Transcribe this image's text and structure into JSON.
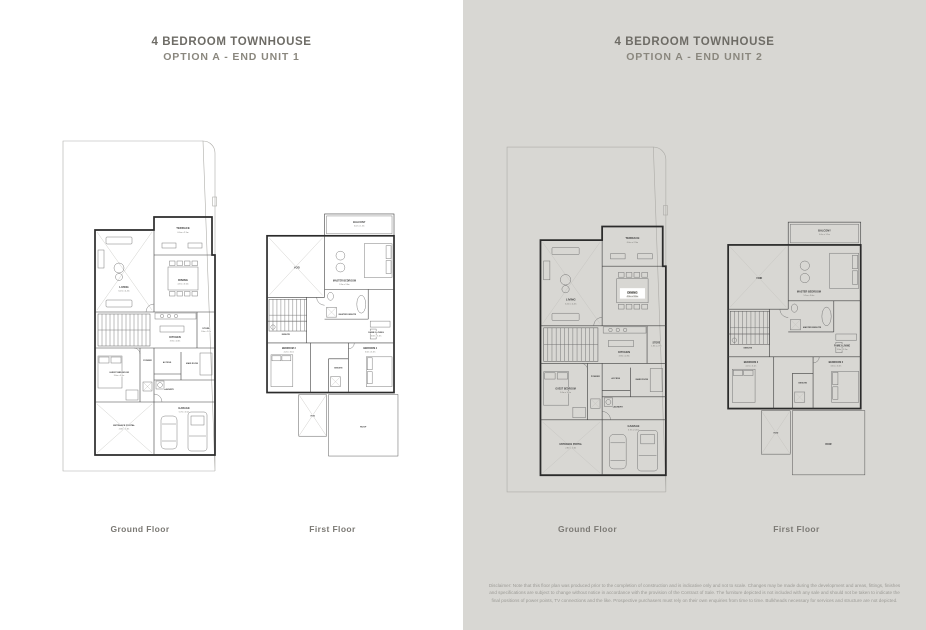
{
  "units": [
    {
      "title": "4 BEDROOM TOWNHOUSE",
      "subtitle": "OPTION A - END UNIT 1",
      "ground_floor_label": "Ground Floor",
      "first_floor_label": "First Floor"
    },
    {
      "title": "4 BEDROOM TOWNHOUSE",
      "subtitle": "OPTION A - END UNIT 2",
      "ground_floor_label": "Ground Floor",
      "first_floor_label": "First Floor"
    }
  ],
  "rooms": {
    "terrace": {
      "label": "TERRACE",
      "dims": "6.0m x 2.9m"
    },
    "living": {
      "label": "LIVING",
      "dims": "6.2m x 4.4m"
    },
    "dining": {
      "label": "DINING",
      "dims": "4.3m x 3.6m"
    },
    "kitchen": {
      "label": "KITCHEN",
      "dims": "3.9m x 2.8m"
    },
    "store": {
      "label": "STORE",
      "dims": "1.8m x 2.7m"
    },
    "guest_bedroom": {
      "label": "GUEST BEDROOM",
      "dims": "3.6m x 3.2m"
    },
    "powder": {
      "label": "POWDER"
    },
    "access": {
      "label": "ACCESS"
    },
    "maid_room": {
      "label": "MAID ROOM",
      "dims": "2.8m x 2.3m"
    },
    "laundry": {
      "label": "LAUNDRY"
    },
    "garage": {
      "label": "GARAGE",
      "dims": "5.7m x 5.5m"
    },
    "entrance_portal": {
      "label": "ENTRANCE PORTAL",
      "dims": "2.8m x 2.3m"
    },
    "balcony": {
      "label": "BALCONY",
      "dims": "6.0m x 1.5m"
    },
    "void": {
      "label": "VOID"
    },
    "master_bedroom": {
      "label": "MASTER BEDROOM",
      "dims": "5.9m x 3.6m"
    },
    "master_ensuite": {
      "label": "MASTER ENSUITE"
    },
    "family_living": {
      "label": "FAMILY LIVING",
      "dims": "3.8m x 3.3m"
    },
    "ensuite": {
      "label": "ENSUITE"
    },
    "bedroom3": {
      "label": "BEDROOM 3",
      "dims": "4.2m x 3.1m"
    },
    "bedroom2": {
      "label": "BEDROOM 2",
      "dims": "3.6m x 3.3m"
    },
    "roof": {
      "label": "ROOF"
    }
  },
  "disclaimer": "Disclaimer: Note that this floor plan was produced prior to the completion of construction and is indicative only and not to scale. Changes may be made during the development and areas, fittings, finishes and specifications are subject to change without notice in accordance with the provision of the Contract of Sale. The furniture depicted is not included with any sale and should not be taken to indicate the final positions of power points, TV connections and the like. Prospective purchasers must rely on their own enquiries from time to time. Bulkheads necessary for services and structure are not depicted.",
  "colors": {
    "left_panel_bg": "#ffffff",
    "right_panel_bg": "#d8d7d3",
    "wall_line": "#2b2b2b",
    "plot_line": "#aeada9",
    "title_text": "#6e6c66",
    "subtitle_text": "#8a877e",
    "floor_label_text": "#7b7974",
    "disclaimer_text": "#9c9b96"
  }
}
